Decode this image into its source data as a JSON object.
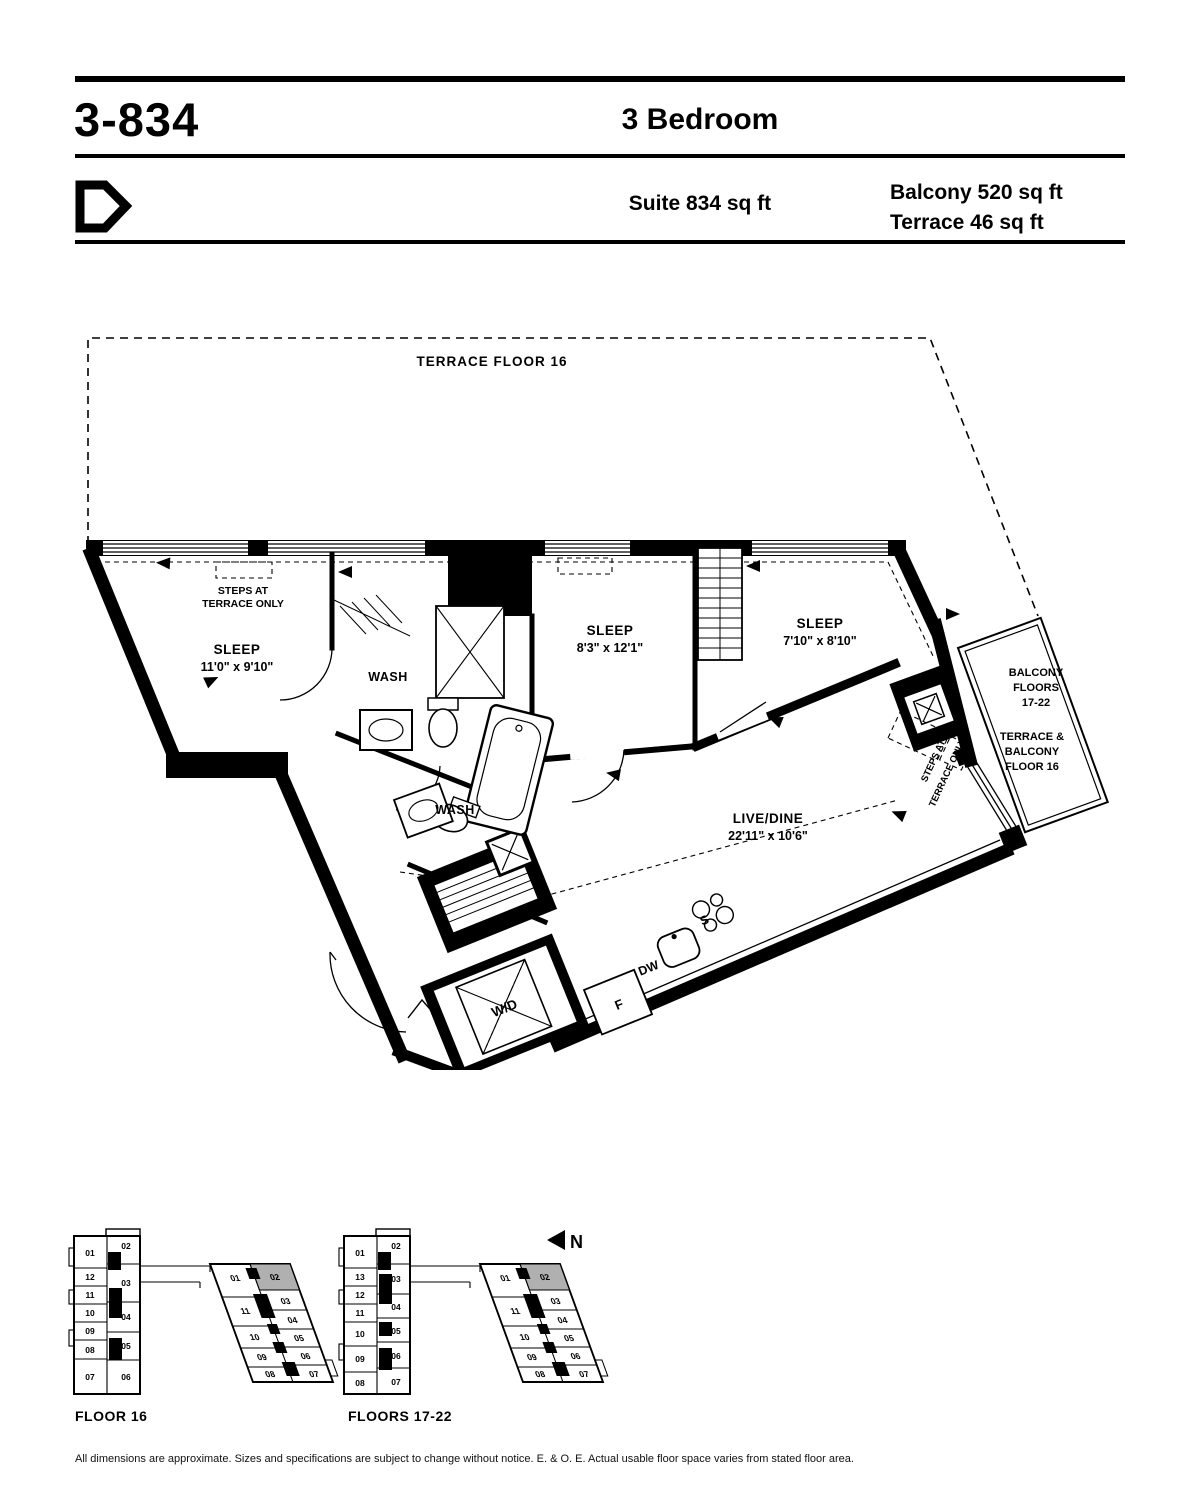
{
  "header": {
    "unit_code": "3-834",
    "unit_type": "3 Bedroom",
    "suite_area": "Suite 834 sq ft",
    "balcony_area": "Balcony 520 sq ft",
    "terrace_area": "Terrace 46 sq ft"
  },
  "plan": {
    "terrace_label": "TERRACE FLOOR 16",
    "steps_note_line1": "STEPS AT",
    "steps_note_line2": "TERRACE ONLY",
    "rooms": {
      "sleep1": {
        "label": "SLEEP",
        "dims": "11'0\" x 9'10\""
      },
      "sleep2": {
        "label": "SLEEP",
        "dims": "8'3\" x 12'1\""
      },
      "sleep3": {
        "label": "SLEEP",
        "dims": "7'10\" x 8'10\""
      },
      "livedine": {
        "label": "LIVE/DINE",
        "dims": "22'11\" x 10'6\""
      },
      "wash1": {
        "label": "WASH"
      },
      "wash2": {
        "label": "WASH"
      }
    },
    "appliances": {
      "washer_dryer": "W/D",
      "fridge": "F",
      "dishwasher": "DW",
      "sink": "S"
    },
    "balcony_upper": {
      "line1": "BALCONY",
      "line2": "FLOORS",
      "line3": "17-22"
    },
    "balcony_lower": {
      "line1": "TERRACE &",
      "line2": "BALCONY",
      "line3": "FLOOR 16"
    }
  },
  "keyplans": {
    "floor16": {
      "caption": "FLOOR 16",
      "tower_left": [
        "01",
        "12",
        "11",
        "10",
        "09",
        "08",
        "07"
      ],
      "tower_right": [
        "02",
        "03",
        "04",
        "05",
        "06"
      ],
      "wing_left": [
        "01",
        "11",
        "10",
        "09",
        "08"
      ],
      "wing_right": [
        "02",
        "03",
        "04",
        "05",
        "06",
        "07"
      ]
    },
    "floors1722": {
      "caption": "FLOORS 17-22",
      "tower_left": [
        "01",
        "13",
        "12",
        "11",
        "10",
        "09",
        "08"
      ],
      "tower_right": [
        "02",
        "03",
        "04",
        "05",
        "06",
        "07"
      ],
      "wing_left": [
        "01",
        "11",
        "10",
        "09",
        "08"
      ],
      "wing_right": [
        "02",
        "03",
        "04",
        "05",
        "06",
        "07"
      ]
    },
    "highlight_unit": "02",
    "highlight_color": "#b0b0b0"
  },
  "north_label": "N",
  "disclaimer": "All dimensions are approximate. Sizes and specifications are subject to change without notice. E. & O. E. Actual usable floor space varies from stated floor area."
}
